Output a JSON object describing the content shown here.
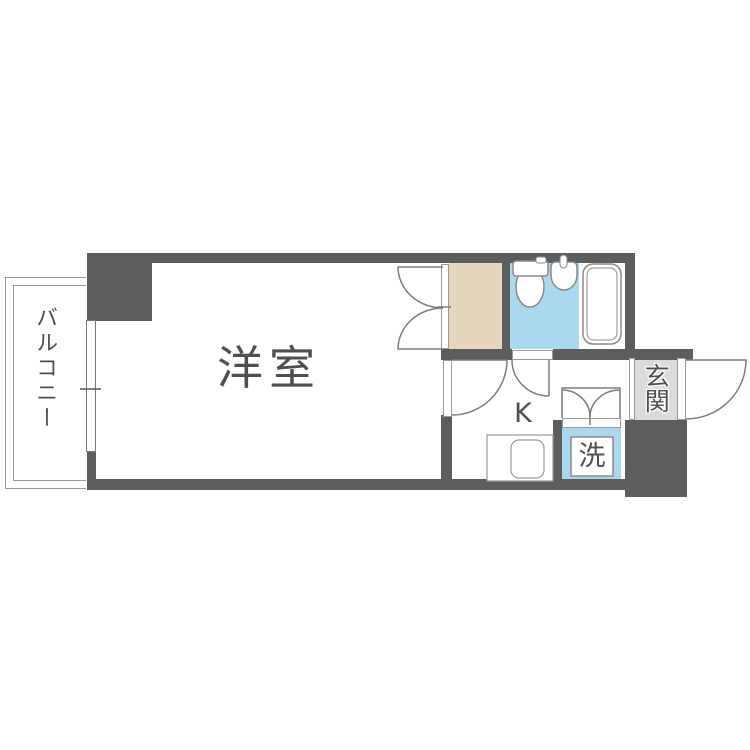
{
  "floorplan": {
    "labels": {
      "balcony": "バルコニー",
      "room": "洋室",
      "kitchen": "K",
      "entrance": "玄関",
      "laundry": "洗"
    },
    "colors": {
      "wall": "#5d5d5d",
      "bathroom_blue": "#a9d8ef",
      "closet_beige": "#e6d6bd",
      "entrance_gray": "#dbdbdb",
      "line_gray": "#8a8a8a",
      "text_gray": "#4f4f4f",
      "background": "#ffffff"
    },
    "fixtures": [
      "toilet",
      "washbasin",
      "bathtub",
      "kitchen-sink",
      "balcony-window",
      "closet-double-door",
      "room-door",
      "bathroom-door",
      "laundry-double-door",
      "entrance-door"
    ]
  }
}
